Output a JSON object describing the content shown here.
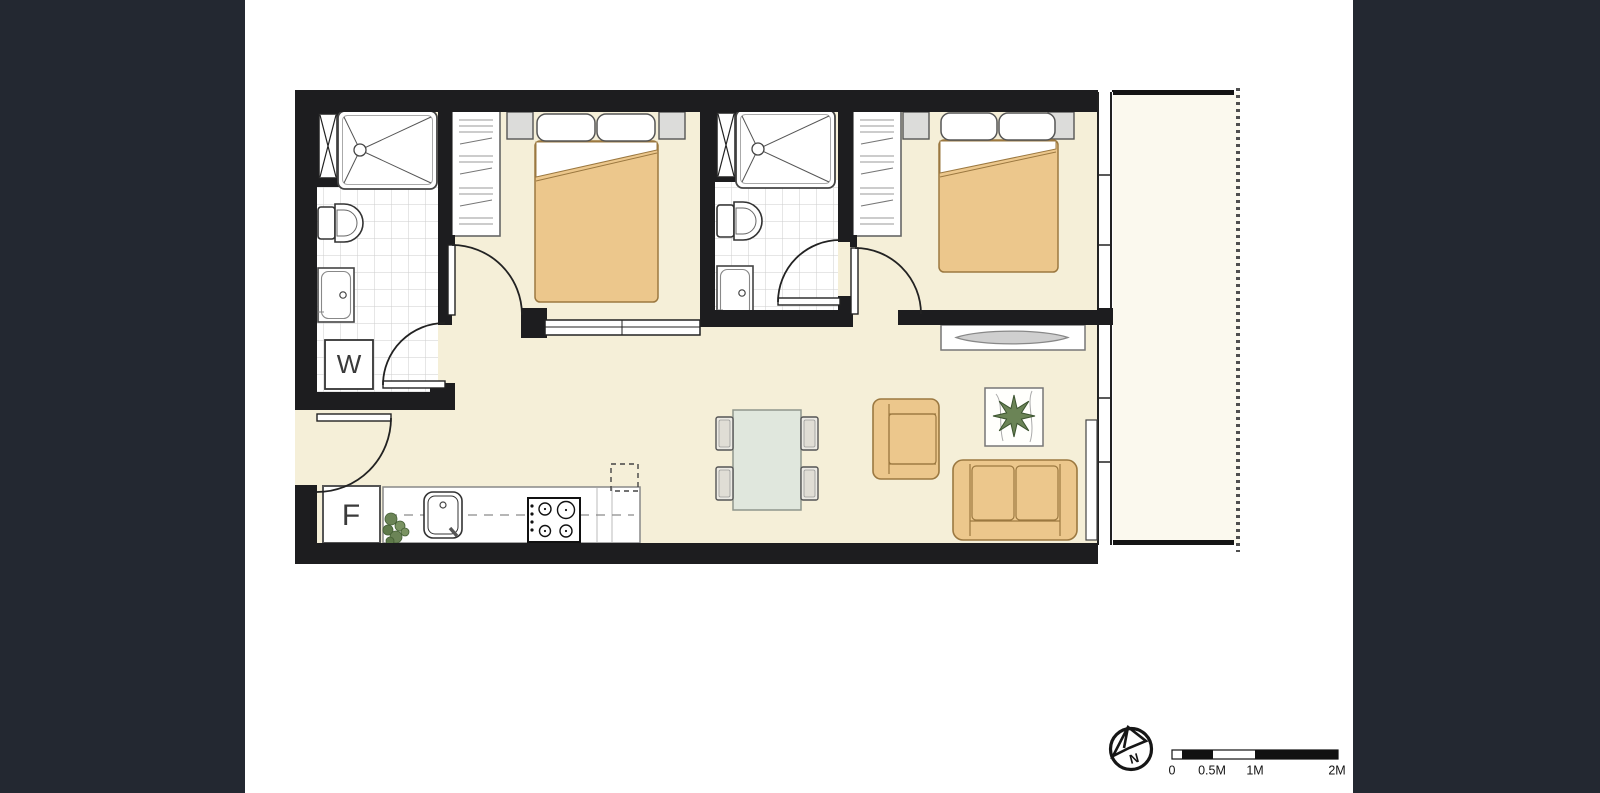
{
  "plan": {
    "labels": {
      "washer": "W",
      "fridge": "F"
    },
    "colors": {
      "letterbox": "#232831",
      "wall": "#1d1d1f",
      "floor": "#f5efd8",
      "balcony_floor": "#fbf9ee",
      "tile_grid": "#cdcdcd",
      "furniture_tan": "#ecc78c",
      "furniture_tan_border": "#9b7840",
      "table_sage": "#e0e7dd",
      "fixture_gray": "#dcdcda",
      "plant_green": "#6b8456"
    }
  },
  "scale_bar": {
    "labels": [
      "0",
      "0.5M",
      "1M",
      "2M"
    ]
  },
  "compass": {
    "letter": "N"
  }
}
